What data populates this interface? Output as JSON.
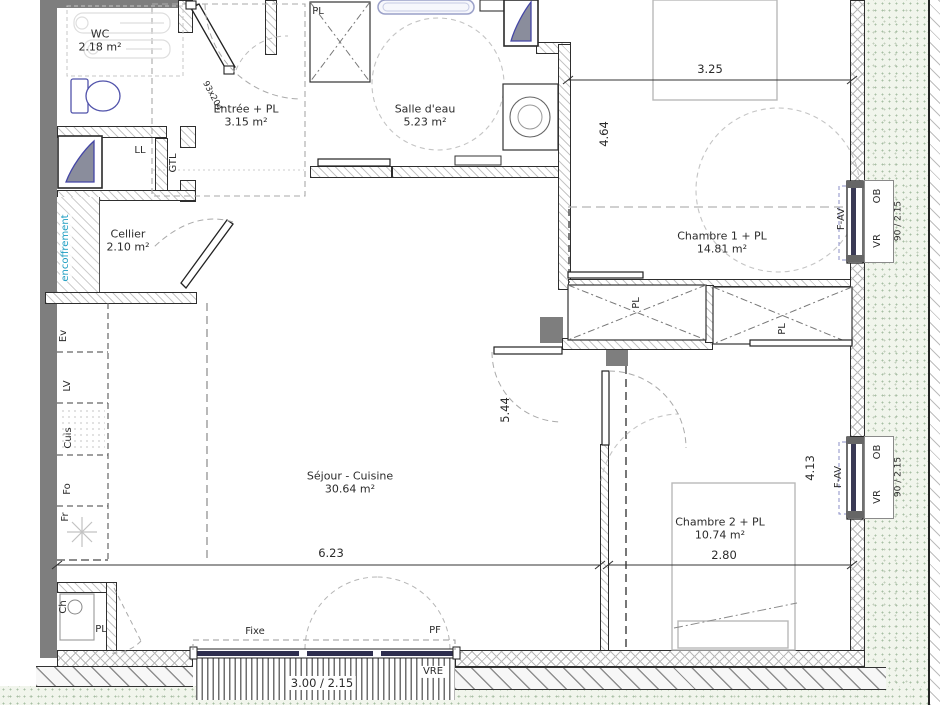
{
  "title": "Plan d'appartement",
  "rooms": {
    "wc": {
      "name": "WC",
      "area": "2.18 m²"
    },
    "entree": {
      "name": "Entrée + PL",
      "area": "3.15 m²"
    },
    "salle_eau": {
      "name": "Salle d'eau",
      "area": "5.23 m²"
    },
    "cellier": {
      "name": "Cellier",
      "area": "2.10 m²"
    },
    "chambre1": {
      "name": "Chambre 1 + PL",
      "area": "14.81 m²"
    },
    "sejour": {
      "name": "Séjour - Cuisine",
      "area": "30.64 m²"
    },
    "chambre2": {
      "name": "Chambre 2 + PL",
      "area": "10.74 m²"
    }
  },
  "dimensions": {
    "chambre1_width": "3.25",
    "chambre1_height": "4.64",
    "sejour_height": "5.44",
    "sejour_width": "6.23",
    "chambre2_width": "2.80",
    "chambre2_height": "4.13",
    "bay_window": "3.00 / 2.15",
    "window_size": "90 / 2.15",
    "entry_door": "93x204"
  },
  "annotations": {
    "ll": "LL",
    "gtl": "GTL",
    "encoffrement": "encoffrement",
    "ev": "Ev",
    "lv": "LV",
    "cuis": "Cuis",
    "fo": "Fo",
    "fr": "Fr",
    "pl": "PL",
    "ch": "Ch",
    "fixe": "Fixe",
    "pf": "PF",
    "vre": "VRE",
    "f_av": "F-AV",
    "ob": "OB",
    "vr": "VR"
  },
  "colors": {
    "wall_dark": "#7e7e7e",
    "glass": "#2e2e4e",
    "fixture_blue": "#5153ab",
    "shaft_fill": "#8a8d9c",
    "shaft_stroke": "#4446a6",
    "encoffrement_text": "#1e9ec2",
    "stipple_green": "#a8bfa4"
  }
}
